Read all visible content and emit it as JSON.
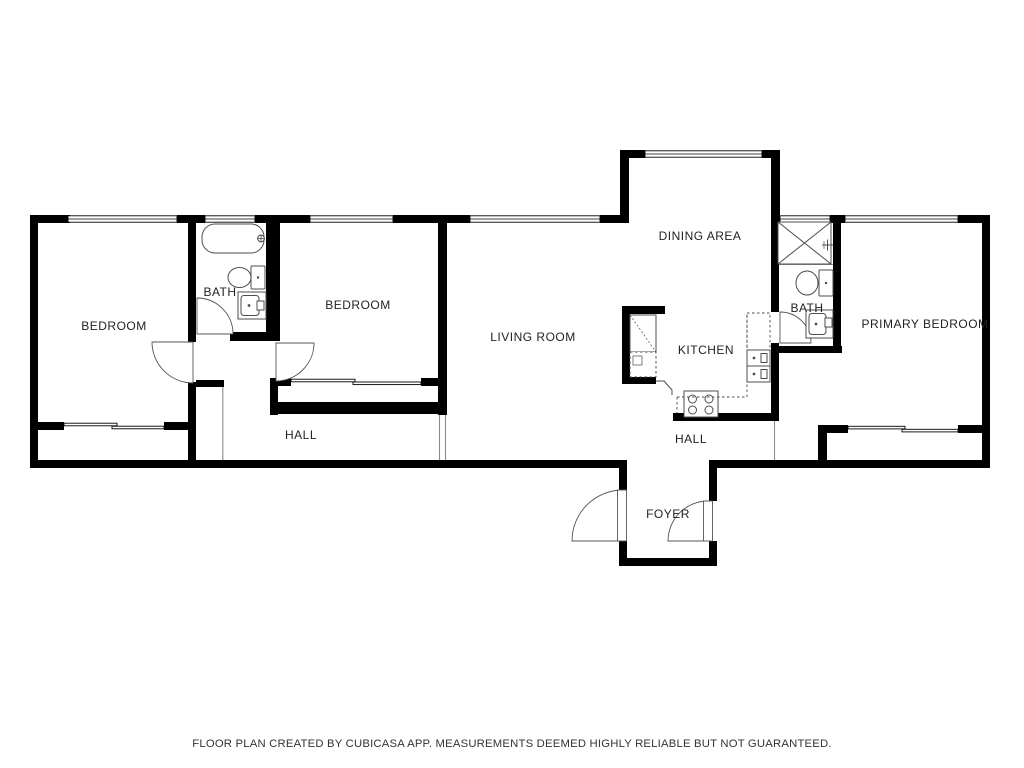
{
  "rooms": [
    {
      "id": "bedroom-1",
      "name": "BEDROOM"
    },
    {
      "id": "bath-1",
      "name": "BATH"
    },
    {
      "id": "bedroom-2",
      "name": "BEDROOM"
    },
    {
      "id": "living-room",
      "name": "LIVING ROOM"
    },
    {
      "id": "dining-area",
      "name": "DINING AREA"
    },
    {
      "id": "kitchen",
      "name": "KITCHEN"
    },
    {
      "id": "bath-2",
      "name": "BATH"
    },
    {
      "id": "primary-bedroom",
      "name": "PRIMARY BEDROOM"
    },
    {
      "id": "hall-west",
      "name": "HALL"
    },
    {
      "id": "hall-east",
      "name": "HALL"
    },
    {
      "id": "foyer",
      "name": "FOYER"
    }
  ],
  "fixtures": [
    "bathtub",
    "toilet",
    "sink",
    "stove",
    "kitchen-counter",
    "cabinet",
    "closet-x",
    "washer-hookup"
  ],
  "footer": {
    "disclaimer": "FLOOR PLAN CREATED BY CUBICASA APP. MEASUREMENTS DEEMED HIGHLY RELIABLE BUT NOT GUARANTEED."
  },
  "colors": {
    "wall": "#000000",
    "fixture_line": "#4d4d4d",
    "thin_line": "#8a8a8a",
    "text": "#222222",
    "background": "#ffffff"
  }
}
